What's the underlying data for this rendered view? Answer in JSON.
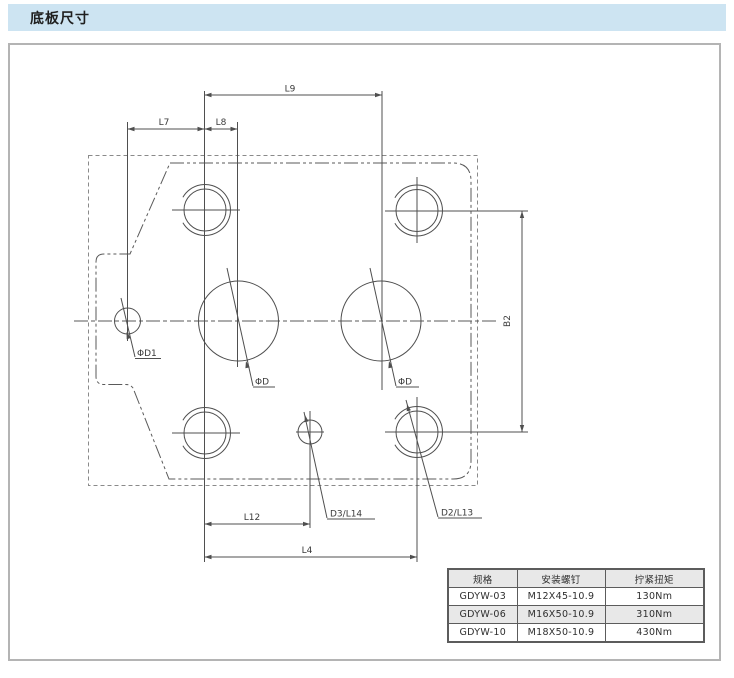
{
  "header": {
    "title": "底板尺寸"
  },
  "drawing": {
    "labels": {
      "l9": "L9",
      "l7": "L7",
      "l8": "L8",
      "l12": "L12",
      "l4": "L4",
      "b2": "B2",
      "phi_d1": "ΦD1",
      "phi_d_left": "ΦD",
      "phi_d_right": "ΦD",
      "d3_l14": "D3/L14",
      "d2_l13": "D2/L13"
    }
  },
  "table": {
    "headers": [
      "规格",
      "安装螺钉",
      "拧紧扭矩"
    ],
    "rows": [
      [
        "GDYW-03",
        "M12X45-10.9",
        "130Nm"
      ],
      [
        "GDYW-06",
        "M16X50-10.9",
        "310Nm"
      ],
      [
        "GDYW-10",
        "M18X50-10.9",
        "430Nm"
      ]
    ]
  },
  "colors": {
    "header_bg": "#cde4f2",
    "line": "#4f4f4f",
    "box_border": "#b4b4b4",
    "table_shade": "#e8e8e8"
  }
}
